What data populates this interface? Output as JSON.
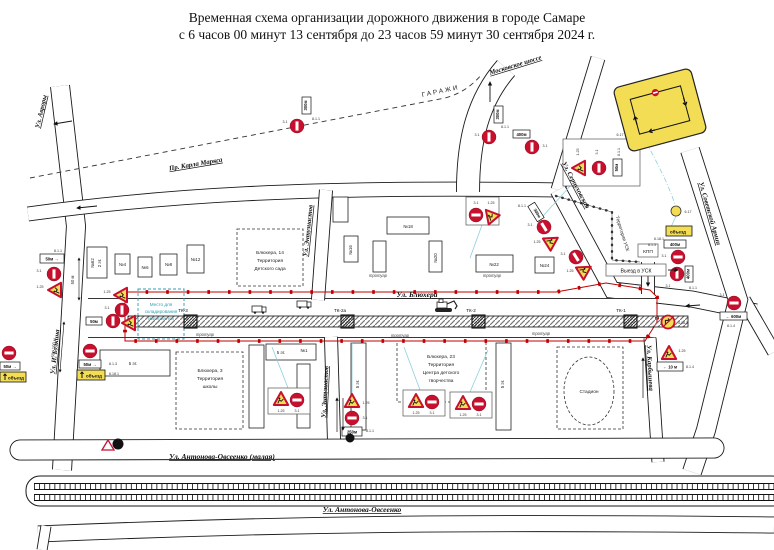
{
  "title": {
    "line1": "Временная схема организации дорожного движения в городе Самаре",
    "line2": "с 6 часов 00 минут 13 сентября до 23 часов 59 минут 30 сентября 2024 г."
  },
  "streets": {
    "moskovskoye": "Московское шоссе",
    "garazhi": "ГАРАЖИ",
    "karla_marksa": "Пр. Карла Маркса",
    "avrory": "Ул. Авроры",
    "bulkina": "Ул. И. Булкина",
    "blyukhera": "Ул. Блюхера",
    "entuziastov": "Ул. Энтузиастов",
    "serpukhovskaya": "Ул. Серпуховская",
    "sovetskoy_armii": "Ул. Советской Армии",
    "karbysheva": "Ул. Карбышева",
    "antonova_malaya": "Ул. Антонова-Овсеенко (малая)",
    "antonova": "Ул. Антонова-Овсеенко",
    "vyezd_usk": "Выезд в УСК"
  },
  "territories": {
    "kinder1": "Блюхера, 14",
    "kinder2": "Территория",
    "kinder3": "Детского сада",
    "school1": "Блюхера, 3",
    "school2": "Территория",
    "school3": "школы",
    "center1": "Блюхера, 23",
    "center2": "Территория",
    "center3": "Центра детского",
    "center4": "творчества",
    "usk": "Территория УСК",
    "stadium": "Стадион",
    "storage1": "Место для",
    "storage2": "складирования",
    "storage3": "материалов",
    "kpp": "КПП"
  },
  "buildings": {
    "b62": "№62",
    "b62f": "2 эт.",
    "b4": "№4",
    "b6": "№6",
    "b8": "№8",
    "b12": "№12",
    "b16": "№16",
    "b18": "№18",
    "b20": "№20",
    "b22": "№22",
    "b24": "№24",
    "b1": "№1",
    "f5": "5 эт."
  },
  "worksite": {
    "tk1": "ТК-1",
    "tk2": "ТК-2",
    "tk2a": "ТК-2а",
    "tk3": "ТК-3",
    "trotuar": "тротуар"
  },
  "signs": {
    "c125": "1.25",
    "c31": "3.1",
    "c811": "8.1.1",
    "c813": "8.1.3",
    "c814": "8.1.4",
    "c6181": "6.18.1",
    "c617": "6.17",
    "c3182": "3.18.2",
    "detour": "объезд",
    "p50": "50м",
    "p50r": "50м →",
    "p250": "250м",
    "p300": "300м",
    "p400": "400м",
    "p600": "← 600м",
    "p10": "← 10 м"
  },
  "dimensions": {
    "d50": "50 м",
    "d50_100": "50 - 100 м"
  },
  "colors": {
    "work_zone": "#c00000",
    "sign_red": "#c8102e",
    "temp_yellow": "#f2dd55",
    "leader": "#8fd0dc"
  }
}
